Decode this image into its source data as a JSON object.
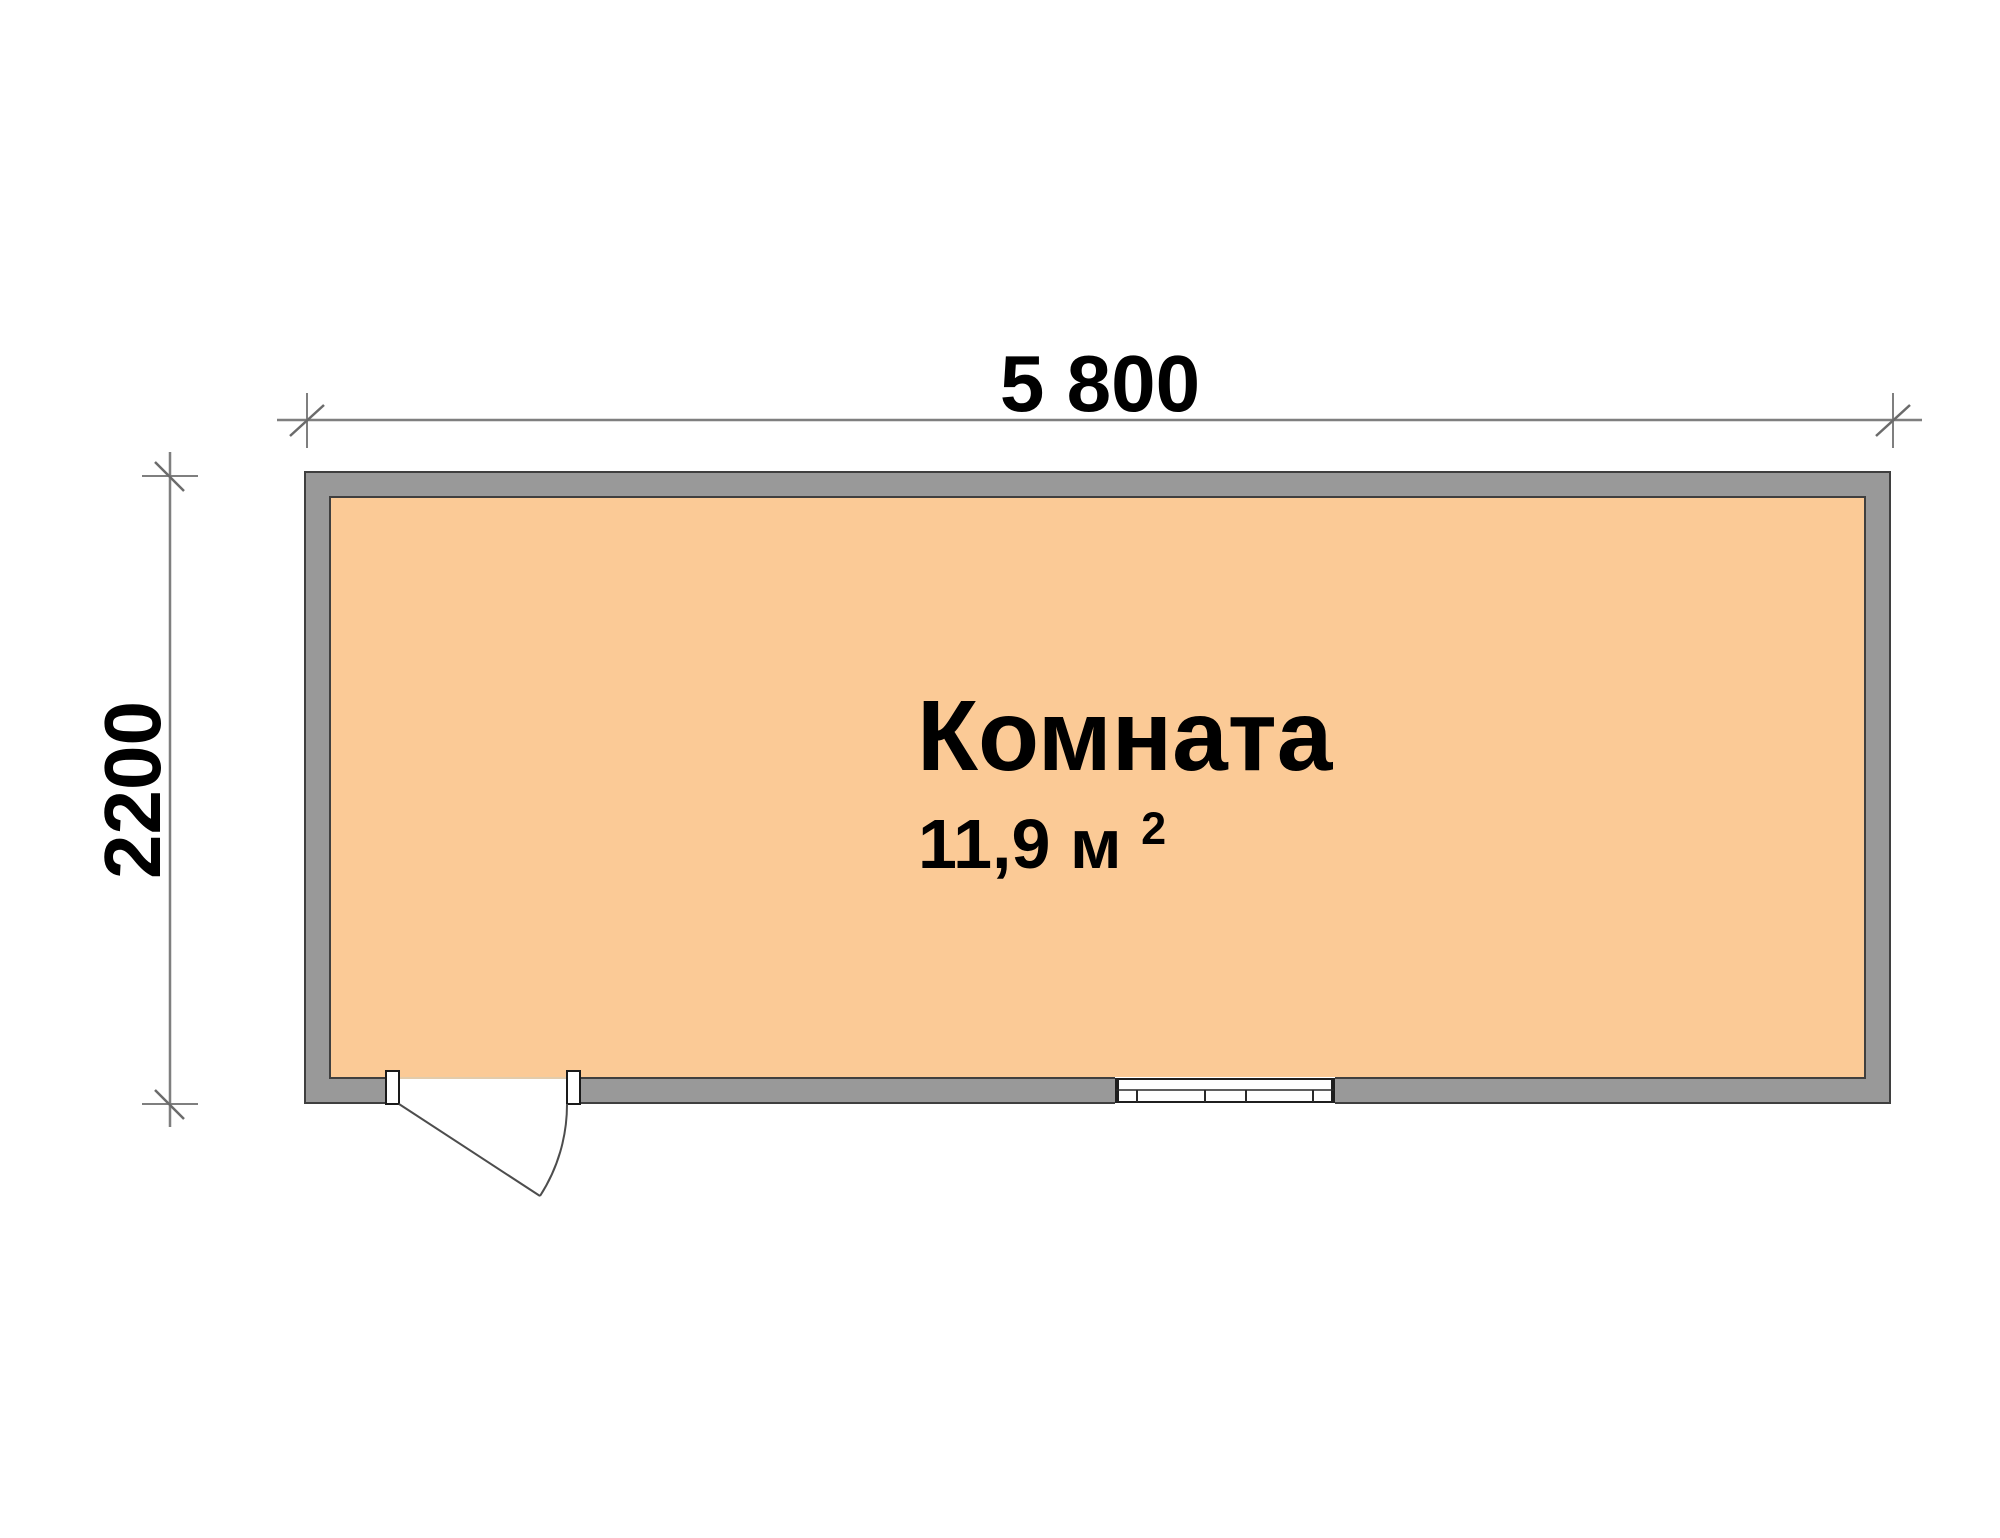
{
  "diagram": {
    "type": "floor-plan",
    "room": {
      "name": "Комната",
      "area_text": "11,9 м",
      "area_superscript": "2"
    },
    "dimensions": {
      "top_width_label": "5 800",
      "left_height_label": "2200"
    },
    "colors": {
      "wall_fill": "#999999",
      "floor_fill": "#fbca96",
      "wall_outline": "#3f3f3f",
      "dimension_line": "#7f7f7f",
      "tick_slash": "#6b6b6b",
      "door_line": "#4d4d4d",
      "window_line": "#1f1f1f",
      "label_text": "#000000",
      "background": "#ffffff"
    },
    "symbols": {
      "door": "door-swing-bottom-left",
      "window": "window-bottom-wall"
    }
  }
}
